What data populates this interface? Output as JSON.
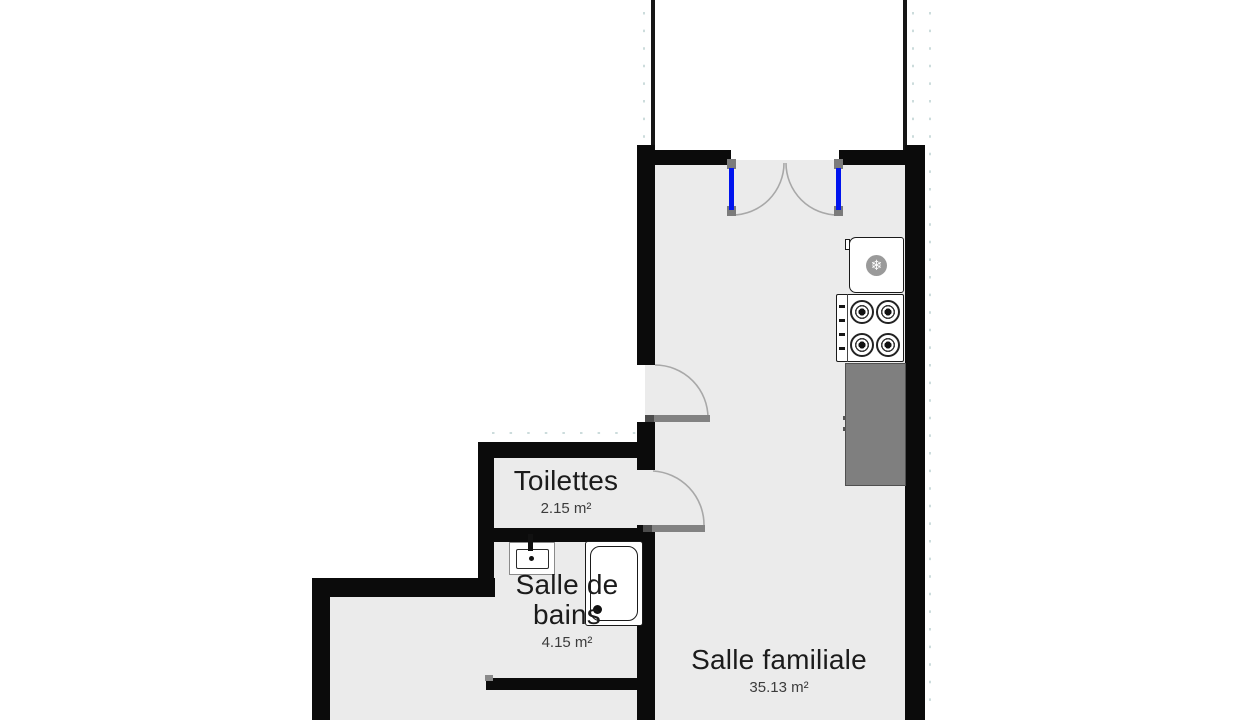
{
  "plan": {
    "title": "Floor plan",
    "rooms": [
      {
        "name": "Toilettes",
        "area": "2.15 m²"
      },
      {
        "name": "Salle de bains",
        "area": "4.15 m²"
      },
      {
        "name": "Salle familiale",
        "area": "35.13 m²"
      }
    ],
    "icons": {
      "refrigerator": "❄"
    },
    "colors": {
      "wall": "#0b0b0b",
      "floor": "#ebebeb",
      "counter": "#7f7f7f",
      "door_panel": "#0014ee",
      "door_leaf": "#828282",
      "arc": "#a8a8a8",
      "tick": "#ccdcdc"
    }
  }
}
